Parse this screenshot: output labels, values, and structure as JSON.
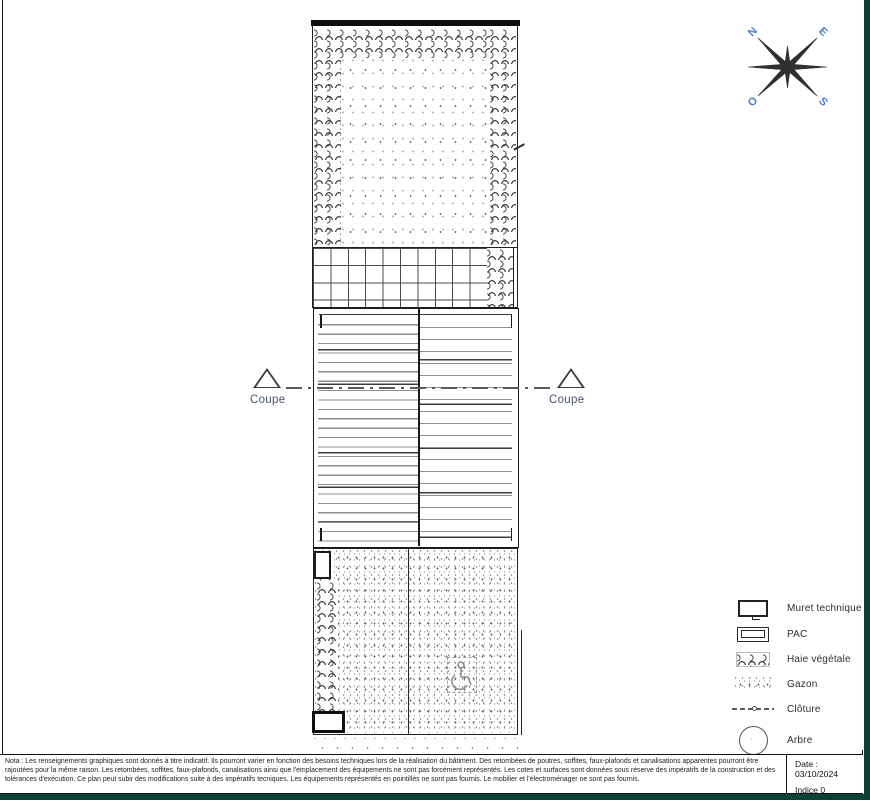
{
  "compass": {
    "north": "N",
    "east": "E",
    "south": "S",
    "west": "O"
  },
  "plan": {
    "section_label_left": "Coupe",
    "section_label_right": "Coupe"
  },
  "legend": {
    "items": [
      {
        "id": "muret-technique",
        "label": "Muret technique"
      },
      {
        "id": "pac",
        "label": "PAC"
      },
      {
        "id": "haie-vegetale",
        "label": "Haie végétale"
      },
      {
        "id": "gazon",
        "label": "Gazon"
      },
      {
        "id": "cloture",
        "label": "Clôture"
      },
      {
        "id": "arbre",
        "label": "Arbre"
      }
    ]
  },
  "footer": {
    "nota": "Nota : Les renseignements graphiques sont donnés à titre indicatif. Ils pourront varier en fonction des besoins techniques lors de la réalisation du bâtiment. Des retombées de poutres, soffites, faux-plafonds et canalisations apparentes pourront être rajoutées pour la même raison. Les retombées, soffites, faux-plafonds, canalisations ainsi que l'emplacement des équipements ne sont pas forcément représentés. Les cotes et surfaces sont données sous réserve des impératifs de la construction et des tolérances d'exécution. Ce plan peut subir des modifications suite à des impératifs tecniques. Les équipements représentés en pointillés ne sont pas fournis. Le mobilier et l'électroménager ne sont pas fournis.",
    "date": "Date : 03/10/2024",
    "indice": "Indice 0"
  },
  "colors": {
    "frame_teal": "#0e4136",
    "compass_letters": "#4a7ed0",
    "coupe_text": "#44546a",
    "line": "#1f1f1f"
  }
}
